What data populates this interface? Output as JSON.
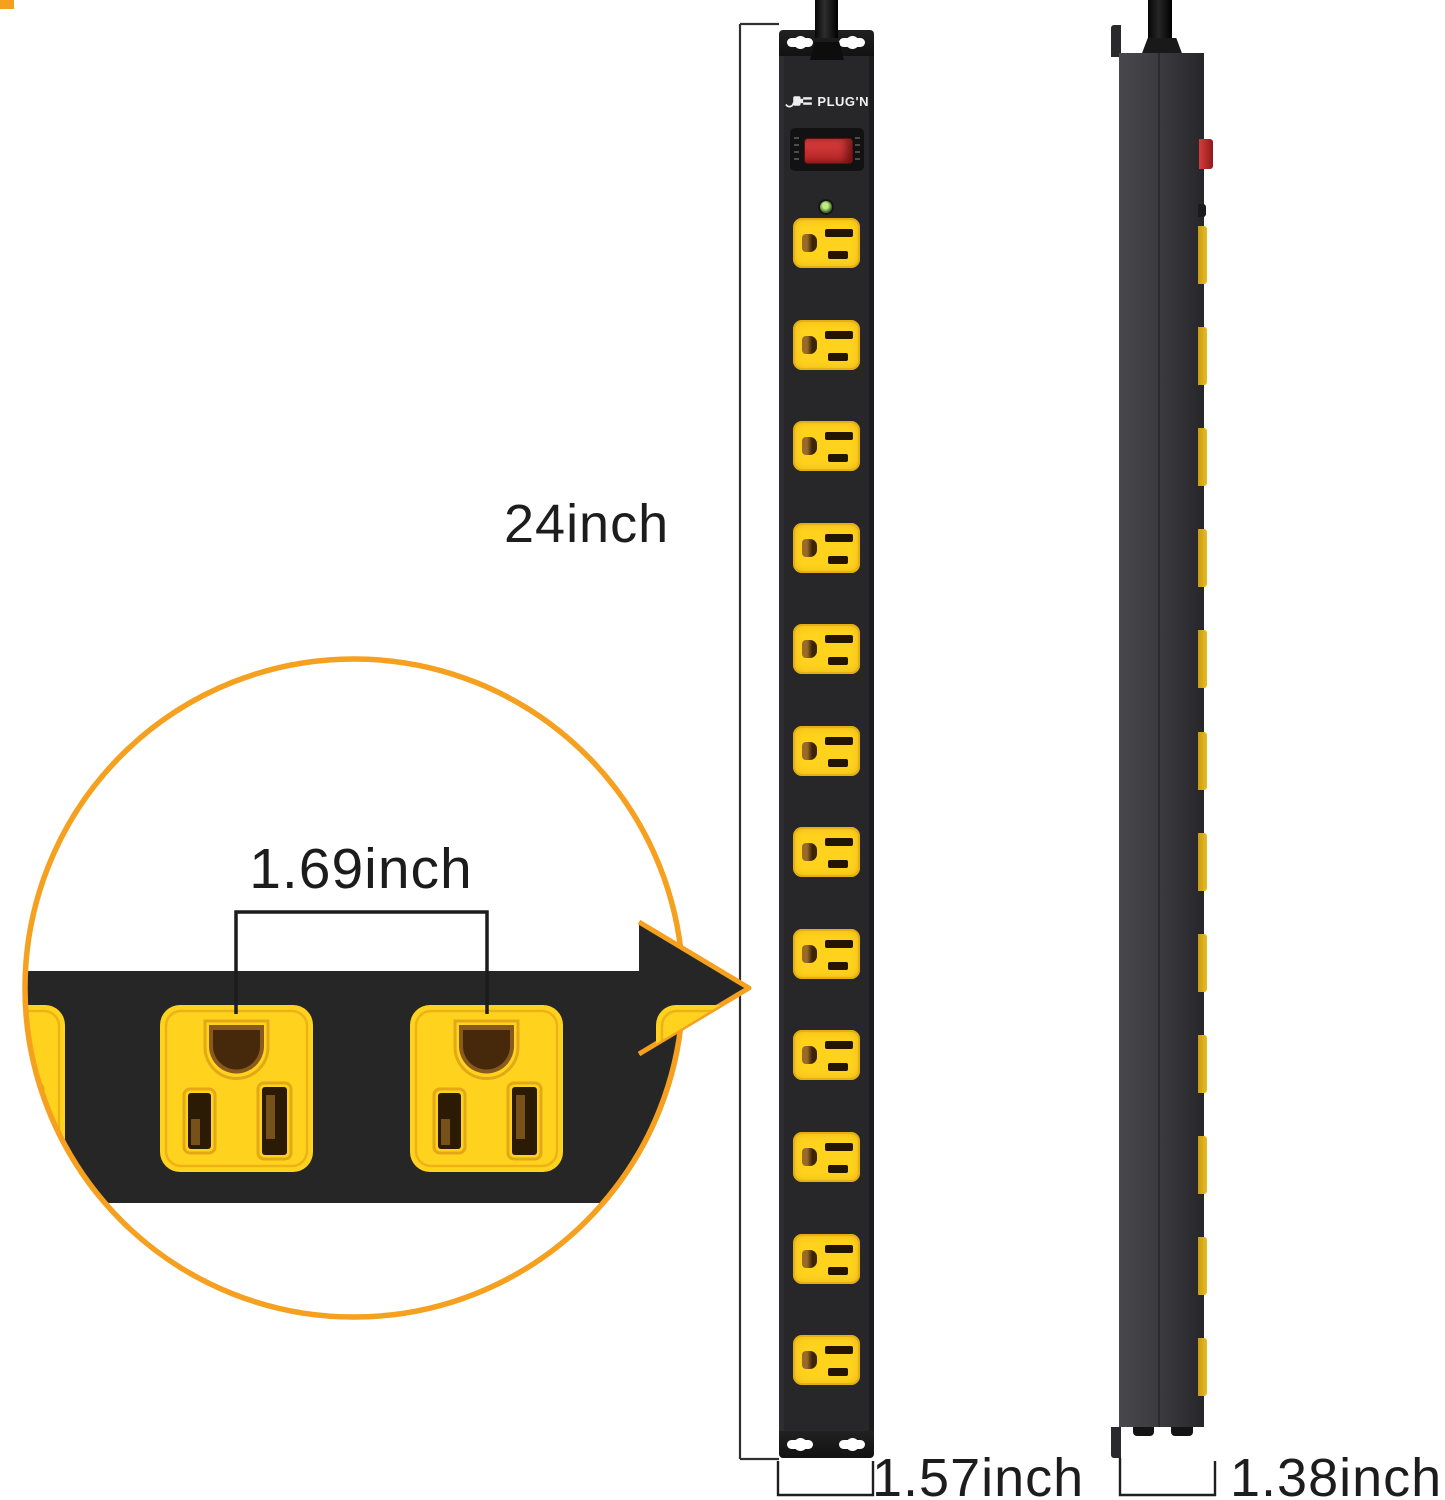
{
  "labels": {
    "height": "24inch",
    "spacing": "1.69inch",
    "width": "1.57inch",
    "depth": "1.38inch"
  },
  "brand": {
    "name": "PLUG'N"
  },
  "front_view": {
    "outlet_count": 12,
    "has_power_switch": true,
    "has_indicator_led": true,
    "mounting_keyholes_top": 2,
    "mounting_keyholes_bottom": 2
  },
  "side_view": {
    "outlet_count": 12,
    "has_power_switch": true
  },
  "callout": {
    "full_outlets_shown": 2,
    "description": "magnified outlet spacing view"
  },
  "colors": {
    "page_bg": "#ffffff",
    "accent": "#f5a01e",
    "outlet_yellow": "#ffd21e",
    "strip_black": "#262626",
    "side_gray": "#3c3c40",
    "switch_red": "#b02424",
    "led_green": "#4a7d2a",
    "text": "#1d1d1d"
  }
}
